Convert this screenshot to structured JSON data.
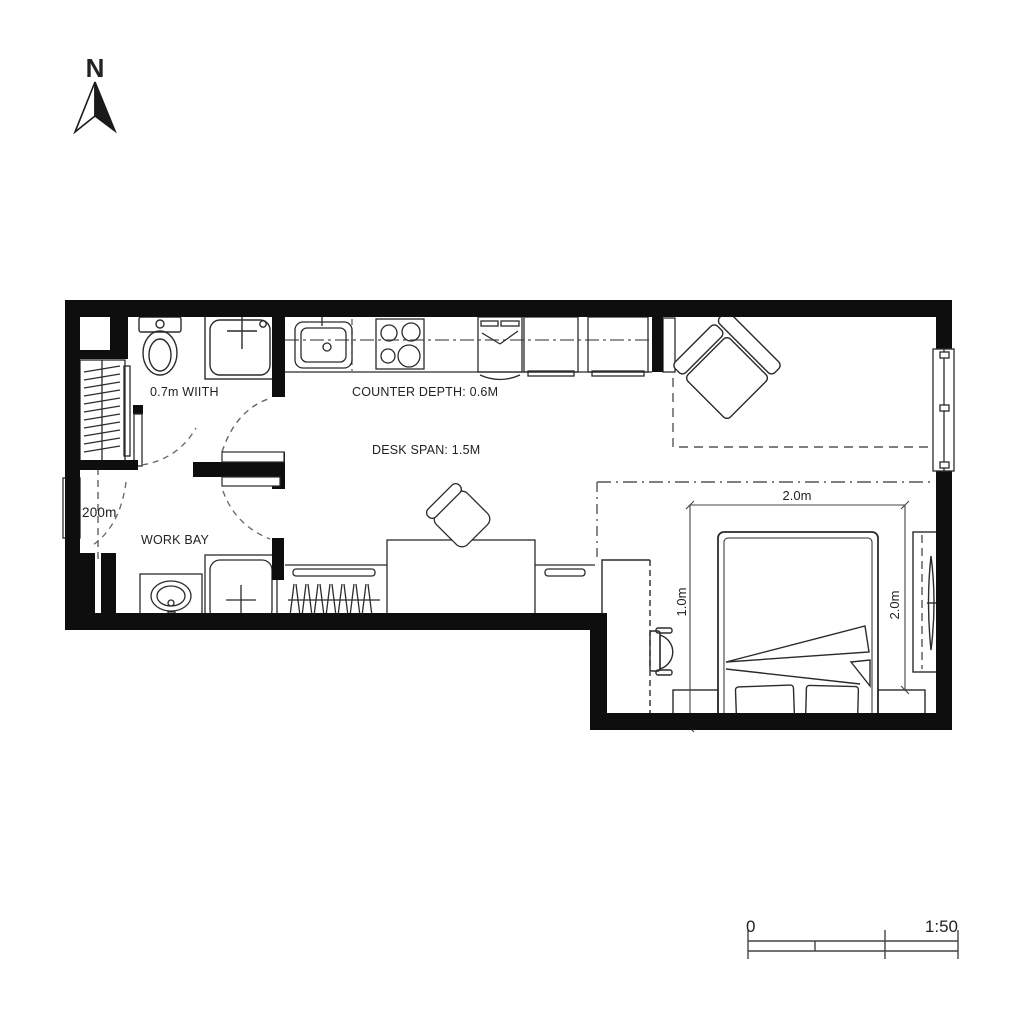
{
  "north": {
    "letter": "N"
  },
  "labels": {
    "bathroom_width": "0.7m WIITH",
    "counter_depth": "COUNTER DEPTH: 0.6M",
    "desk_span": "DESK SPAN: 1.5M",
    "work_bay": "WORK BAY",
    "hall_width": "200m"
  },
  "dimensions": {
    "bed_width_top": "2.0m",
    "desk_depth_left": "1.0m",
    "bed_length_right": "2.0m"
  },
  "scale_bar": {
    "zero": "0",
    "ratio": "1:50"
  },
  "colors": {
    "wall": "#0e0e0e",
    "line": "#2b2b2b",
    "background": "#ffffff"
  }
}
